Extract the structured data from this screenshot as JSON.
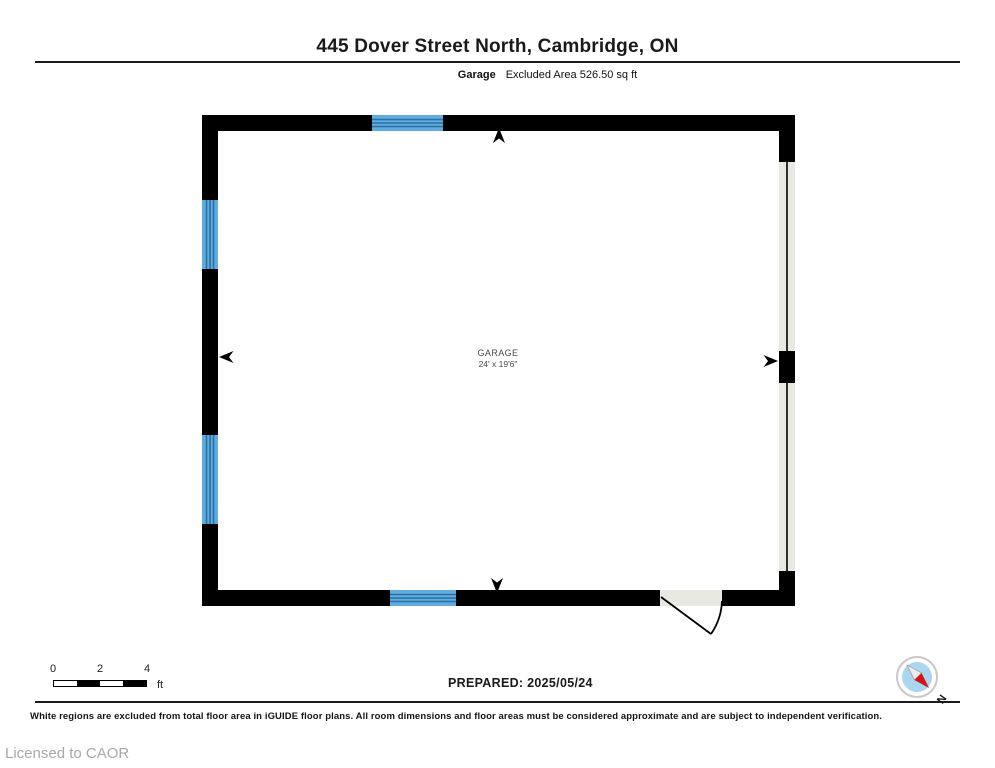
{
  "page": {
    "title": "445 Dover Street North, Cambridge, ON"
  },
  "header": {
    "room_label": "Garage",
    "area_label": "Excluded Area 526.50 sq ft"
  },
  "floorplan": {
    "room_name": "GARAGE",
    "room_dimensions": "24' x 19'6\"",
    "colors": {
      "wall": "#000000",
      "window_fill": "#5fade0",
      "window_pane_line": "#2d6f9f",
      "door_fill": "#e9e9e4"
    }
  },
  "scale_bar": {
    "ticks": [
      "0",
      "2",
      "4"
    ],
    "unit": "ft"
  },
  "footer": {
    "prepared": "PREPARED: 2025/05/24",
    "disclaimer": "White regions are excluded from total floor area in iGUIDE floor plans. All room dimensions and floor areas must be considered approximate and are subject to independent verification.",
    "license": "Licensed to CAOR"
  },
  "compass": {
    "label": "N",
    "needle_color": "#d31616",
    "face_color": "#abd6ef"
  }
}
